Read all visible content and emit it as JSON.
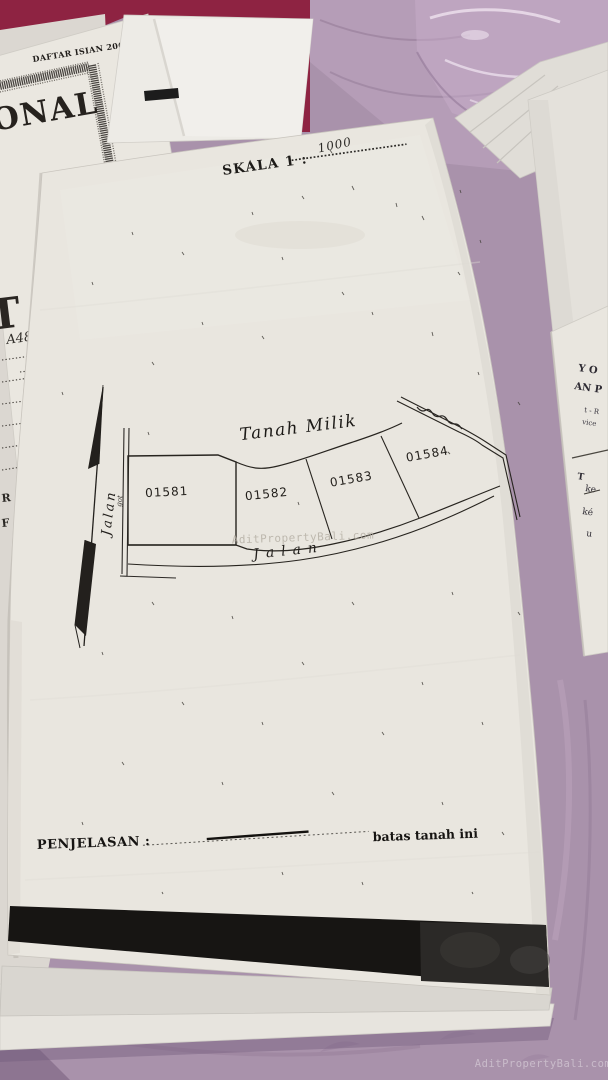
{
  "documents": {
    "form_daftar_isian": {
      "title": "DAFTAR ISIAN 206",
      "large_word_fragment": "ONAL",
      "large_letter_fragment": "T",
      "handwritten_code": "A48",
      "text_fragment_1": "R",
      "text_fragment_2": "F"
    },
    "right_sheet": {
      "fragments": [
        "Y O",
        "AN P",
        "t - R",
        "vice",
        "T",
        "ke",
        "ké",
        "u"
      ]
    },
    "survey_sheet": {
      "scale_label": "SKALA 1 :",
      "scale_value": "1000",
      "map": {
        "land_label": "Tanah Milik",
        "left_road_label": "Jalan",
        "drain_note": "got",
        "bottom_road_label": "Jalan",
        "parcels": [
          {
            "id": "01581"
          },
          {
            "id": "01582"
          },
          {
            "id": "01583"
          },
          {
            "id": "01584"
          }
        ]
      },
      "legend_label": "PENJELASAN :",
      "legend_meaning": "batas tanah ini"
    }
  },
  "watermarks": {
    "center": "AditPropertyBali.com",
    "bottom_right": "AditPropertyBali.com"
  },
  "colors": {
    "tablecloth": "#a992ab",
    "folder": "#8e2342",
    "paper": "#e9e6df",
    "ink": "#1a1a1a"
  }
}
